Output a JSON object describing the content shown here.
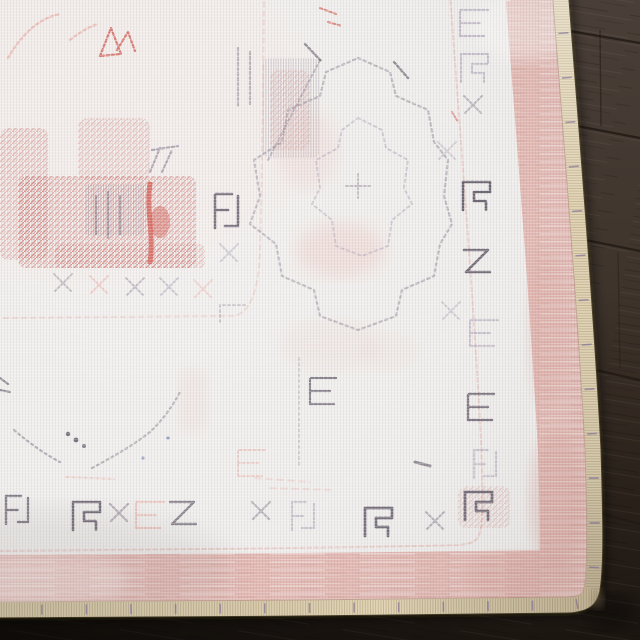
{
  "scene": {
    "type": "photograph",
    "subject": "corner of a faded ivory vintage-style rug with pink borders and washed-out red and grey oriental motifs, lying on a dark espresso wood plank floor",
    "camera": "angled top-down view, rug fills frame except a wood strip along the right edge and bottom edge"
  },
  "regions": {
    "floor": "dark brown wood planks, seams sloping slightly down to the right, nearly black in shadow at the bottom",
    "rug_field": "off-white field, top-left, with faded red floral sprays and grey-purple speckled motifs",
    "medallion": "large very faded stepped-diamond medallion outlined in dotted grey",
    "minor_border": "row of small faded x-motifs and dark bracket glyphs framing the field",
    "main_border": "ivory band with faded grey hooked glyph motifs along right side and bottom",
    "pink_band": "washed rose-pink outer band, about 55px wide, following the rug edge",
    "binding": "cream serged binding edge with whip stitches and tiny purple thread flecks"
  },
  "palette": {
    "floor_top": "#4a3f38",
    "floor_mid": "#3e342c",
    "floor_low": "#2b221b",
    "floor_bottom": "#1c1611",
    "plank_seam": "#221a14",
    "rug_base": "#f0eeec",
    "rug_shadow_tint": "#847e7a",
    "binding": "#e2d5b6",
    "binding_light": "#efe5ca",
    "binding_dark": "#c9b795",
    "binding_rim": "#8a765a",
    "stitch": "#a4916f",
    "fleck_purple": "#6e5f93",
    "pink_band": "#e3b7b1",
    "pink_deep": "#d79f97",
    "pink_light": "#f2dedb",
    "guard_pink": "#dfa9a1",
    "motif_red": "#cf4f45",
    "motif_red_deep": "#b23a33",
    "motif_red_faint": "#eab5ae",
    "motif_gray": "#8b7f91",
    "motif_gray_dark": "#554b5c",
    "motif_gray_faint": "#b3a9bc",
    "motif_blue": "#7b86b8",
    "field_wash": "#f3e9e7"
  }
}
